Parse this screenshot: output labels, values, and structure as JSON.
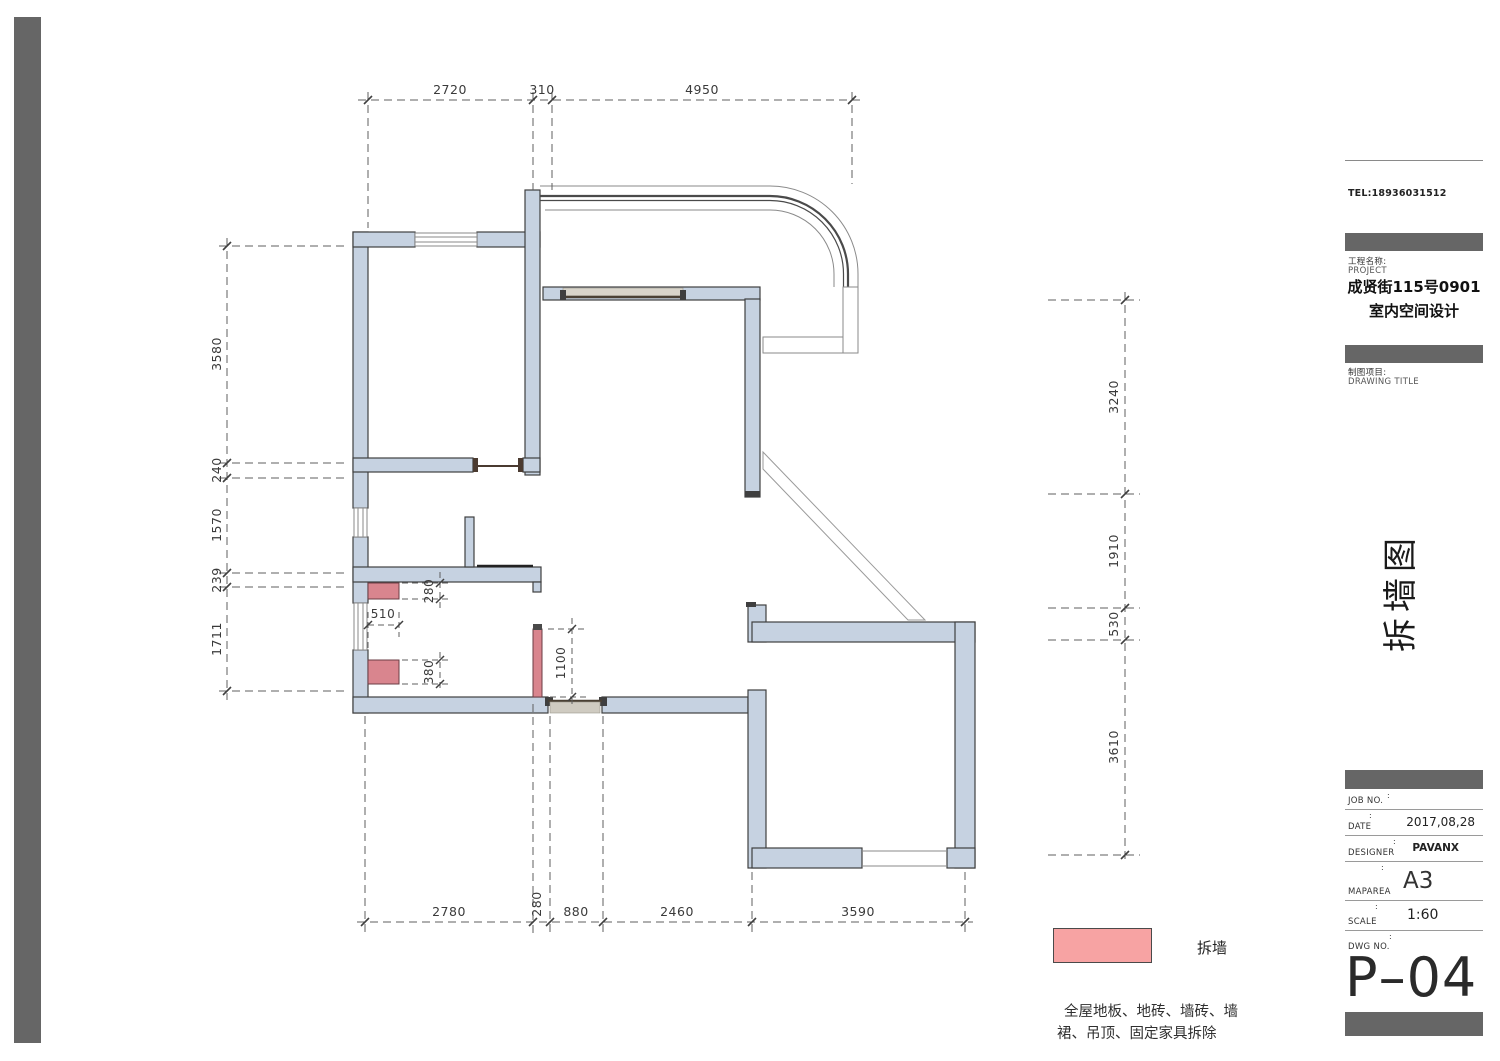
{
  "dims": {
    "top": [
      "2720",
      "310",
      "4950"
    ],
    "left": [
      "3580",
      "240",
      "1570",
      "239",
      "1711"
    ],
    "right": [
      "3240",
      "1910",
      "530",
      "3610"
    ],
    "bottom": [
      "2780",
      "280",
      "880",
      "2460",
      "3590"
    ],
    "inner": {
      "w280": "280",
      "w510": "510",
      "w380": "380",
      "w1100": "1100"
    }
  },
  "legend": {
    "label": "拆墙",
    "color": "#f7a3a3"
  },
  "note": {
    "text": "全屋地板、地砖、墙砖、墙裙、吊顶、固定家具拆除"
  },
  "titleblock": {
    "tel": "TEL:18936031512",
    "project_label": "工程名称:",
    "project_label_en": "PROJECT",
    "project_name_line1": "成贤街115号0901",
    "project_name_line2": "室内空间设计",
    "drawing_label": "制图项目:",
    "drawing_label_en": "DRAWING TITLE",
    "side_title": "拆墙图",
    "colon": ":",
    "rows": [
      {
        "label": "JOB NO.",
        "value": ""
      },
      {
        "label": "DATE",
        "value": "2017,08,28"
      },
      {
        "label": "DESIGNER",
        "value": "PAVANX"
      },
      {
        "label": "MAPAREA",
        "value": "A3"
      },
      {
        "label": "SCALE",
        "value": "1:60"
      },
      {
        "label": "DWG NO.",
        "value": ""
      }
    ],
    "dwg_code": "P–04"
  },
  "colors": {
    "wall_fill": "#c6d2e1",
    "wall_stroke": "#3f3f3f",
    "demolish_fill": "#d9858e",
    "legend_fill": "#f7a3a3",
    "sidebar": "#666666"
  }
}
